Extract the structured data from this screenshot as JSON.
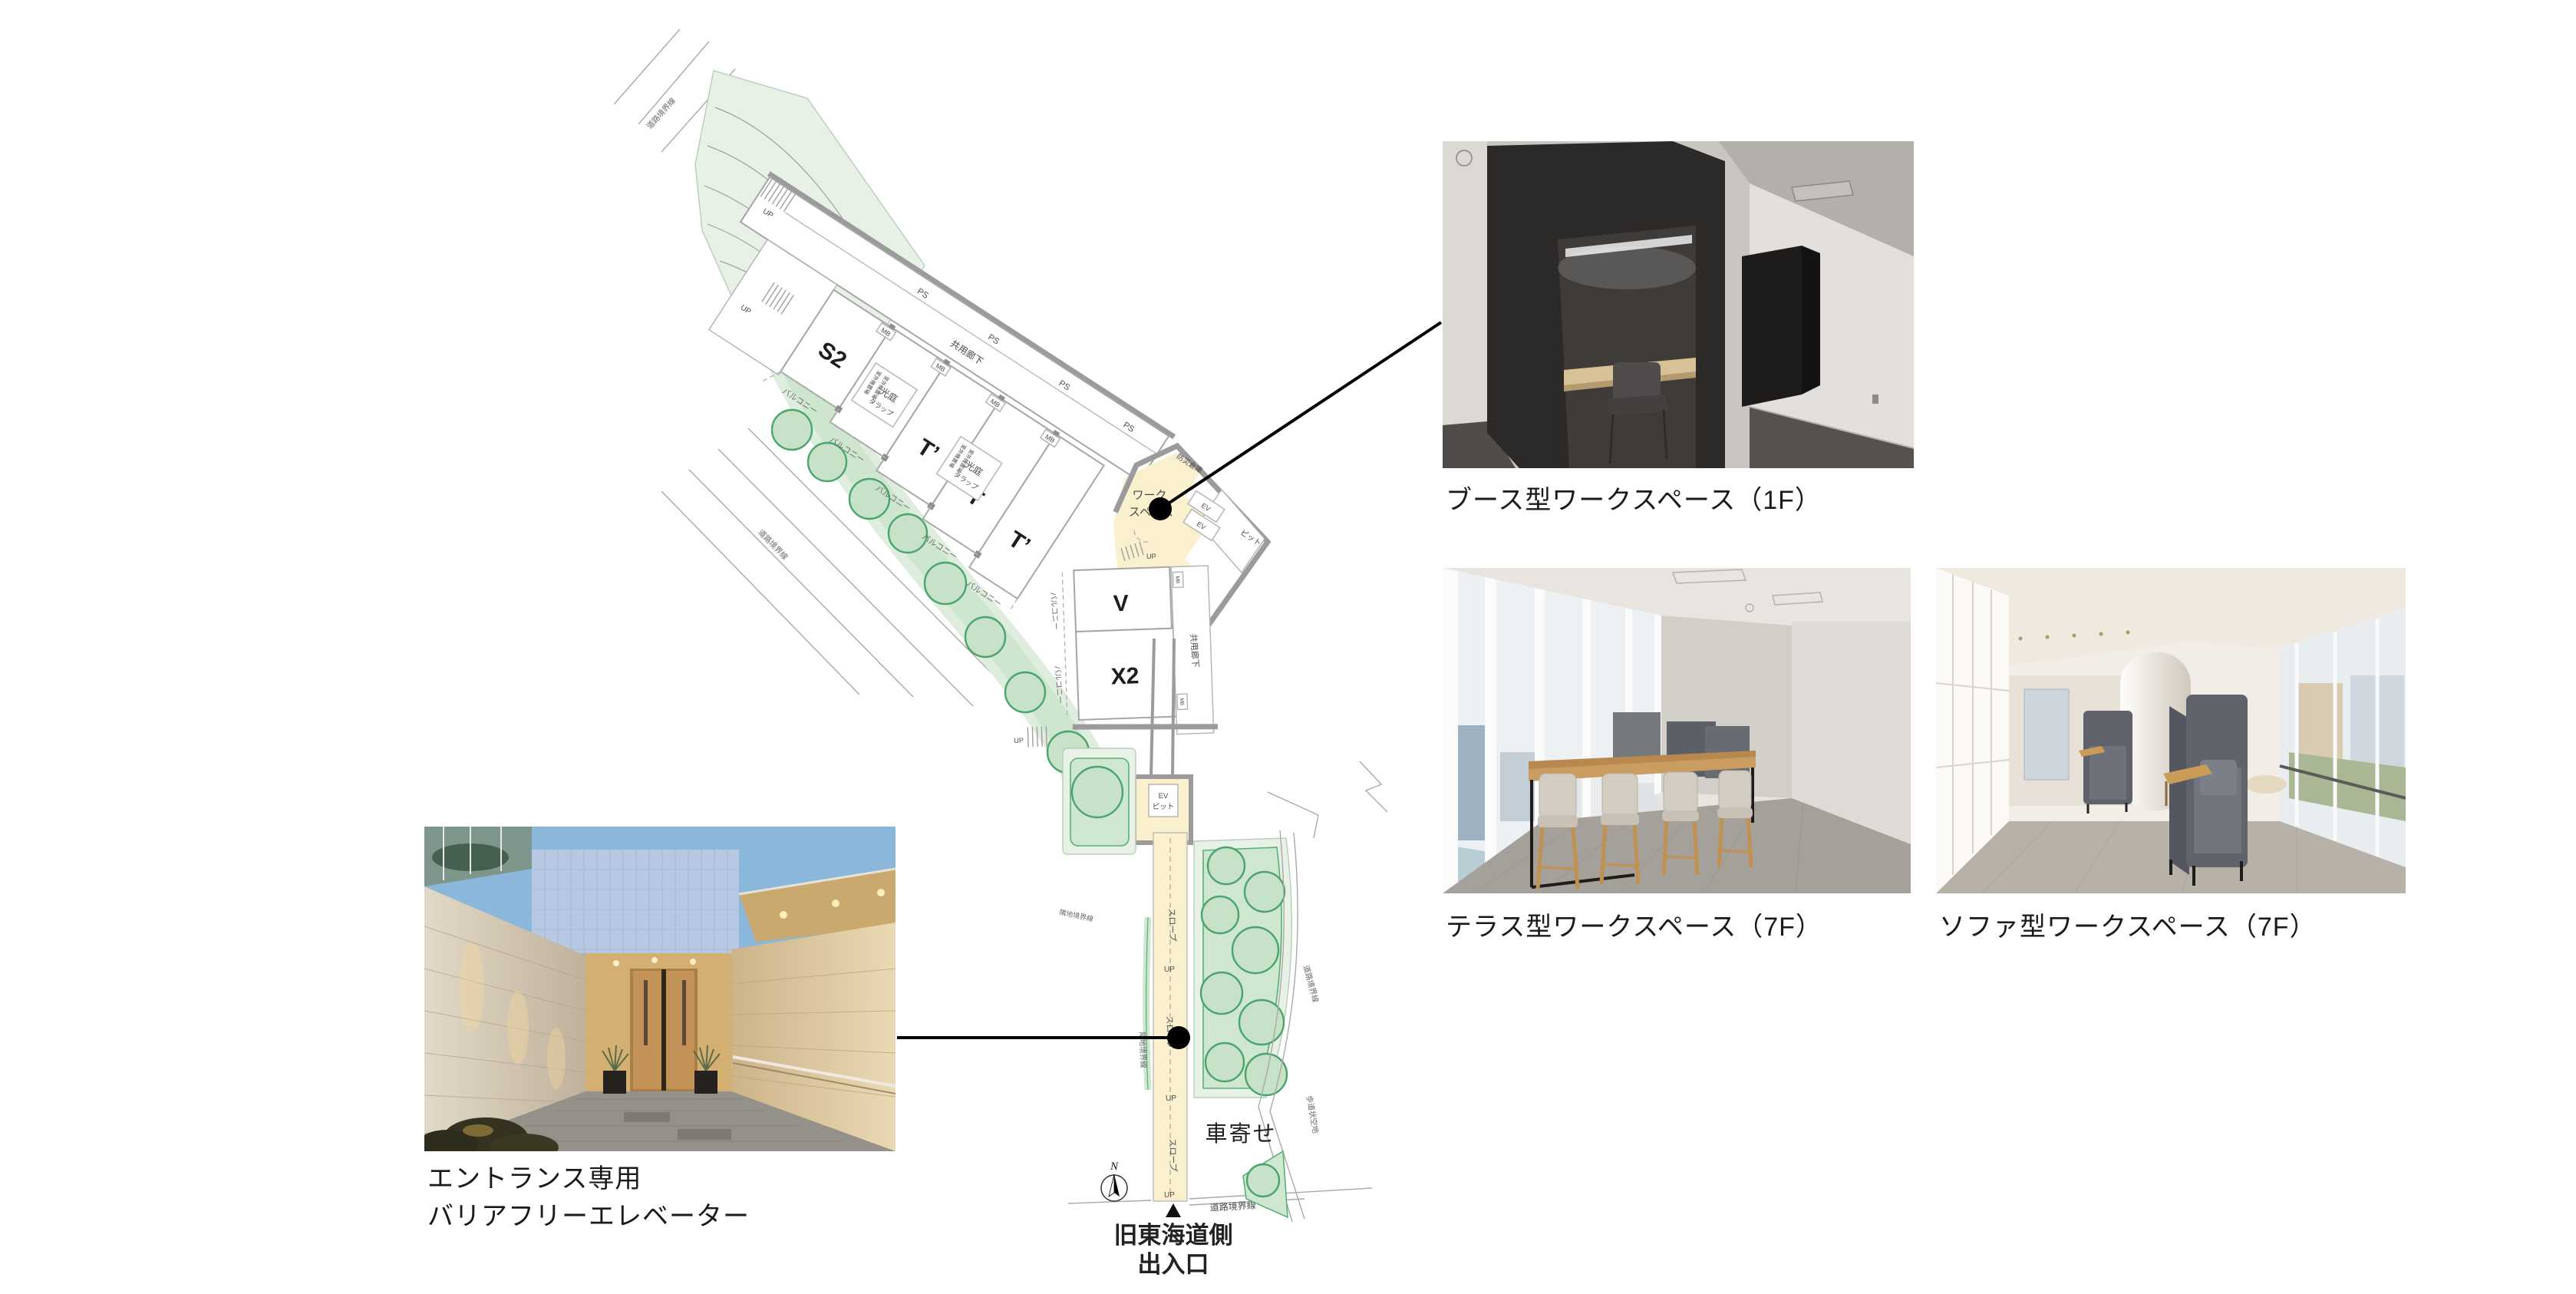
{
  "colors": {
    "plan_highlight": "#FAF0CD",
    "plan_green": "#DFEDDE",
    "plan_green_dark": "#CDE6CD",
    "tree_green": "#4AA56C",
    "wall_gray": "#9B9B9B",
    "leader_black": "#000000"
  },
  "plan": {
    "rooms": {
      "s2": "S2",
      "u": "U",
      "t_prime": "T’",
      "t": "T",
      "v": "V",
      "x2": "X2"
    },
    "workspace": {
      "line1": "ワーク",
      "line2": "スペース"
    },
    "labels": {
      "ps": "PS",
      "mb": "MB",
      "corridor": "共用廊下",
      "balcony": "バルコニー",
      "koutei": "光庭",
      "tarappu": "タラップ",
      "outdoor_unit": "室外機置場",
      "up": "UP",
      "slope": "スロープ",
      "bousai": "防災倉庫",
      "pit": "ピット",
      "ev": "EV",
      "ev_pit_1": "EV",
      "ev_pit_2": "ピット",
      "rinchi": "隣地境界線",
      "doro": "道路境界線",
      "hodo": "歩道状空地",
      "kurumayose": "車寄せ",
      "north": "N",
      "exit_1": "旧東海道側",
      "exit_2": "出入口"
    }
  },
  "captions": {
    "booth": "ブース型ワークスペース（1F）",
    "terrace": "テラス型ワークスペース（7F）",
    "sofa": "ソファ型ワークスペース（7F）",
    "entrance_1": "エントランス専用",
    "entrance_2": "バリアフリーエレベーター"
  }
}
